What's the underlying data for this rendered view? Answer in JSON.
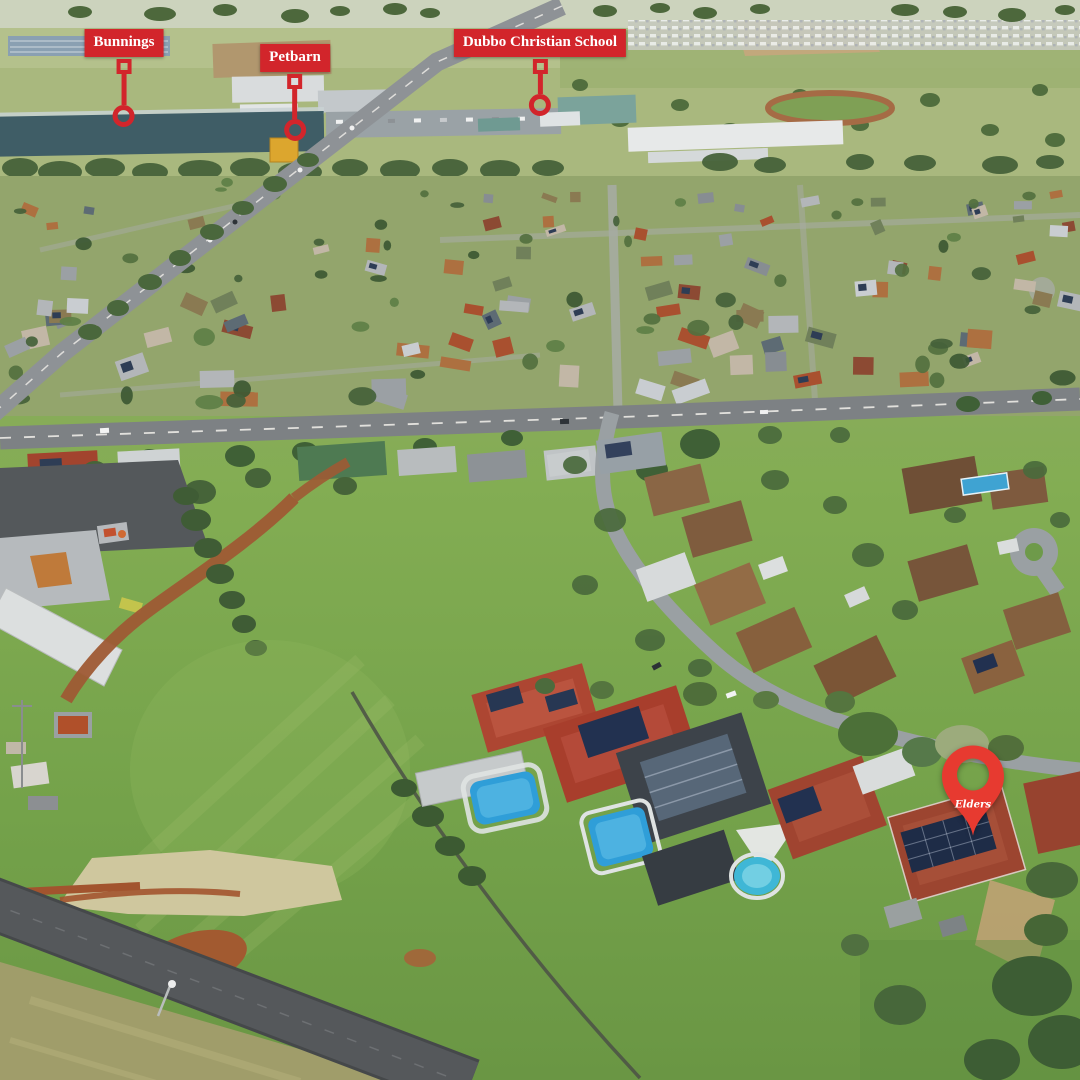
{
  "annotations": {
    "markers": [
      {
        "label": "Bunnings"
      },
      {
        "label": "Petbarn"
      },
      {
        "label": "Dubbo Christian School"
      }
    ],
    "pin": {
      "brand": "Elders"
    }
  },
  "colors": {
    "marker_red": "#d2252b",
    "pin_red": "#e73a30",
    "label_text": "#ffffff"
  }
}
